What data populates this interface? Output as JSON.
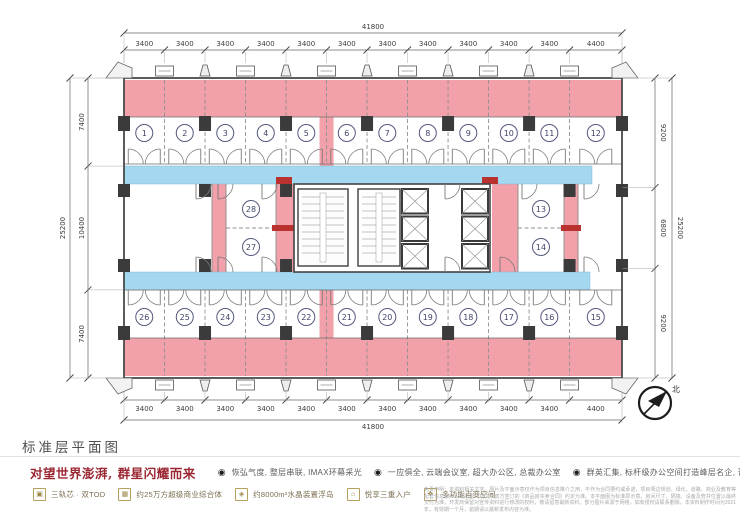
{
  "plan": {
    "title": "标准层平面图",
    "compass_label": "北",
    "colors": {
      "pink": "#f2a0a9",
      "red": "#b9322f",
      "blue": "#a4d7f0",
      "column": "#3b3b3b",
      "wall": "#6e6e6e",
      "dim": "#3c3c3c",
      "circle": "#55597d",
      "number": "#3f4468"
    },
    "dims": {
      "top_total_mm": 41800,
      "top_segments_mm": [
        3400,
        3400,
        3400,
        3400,
        3400,
        3400,
        3400,
        3400,
        3400,
        3400,
        3400,
        4400
      ],
      "bottom_total_mm": 41800,
      "bottom_segments_mm": [
        3400,
        3400,
        3400,
        3400,
        3400,
        3400,
        3400,
        3400,
        3400,
        3400,
        3400,
        4400
      ],
      "left_total_mm": 25200,
      "left_segments_mm": [
        7400,
        10400,
        7400
      ],
      "right_total_mm": 25200,
      "right_segments_mm": [
        9200,
        6800,
        9200
      ]
    },
    "rooms": {
      "top": [
        "1",
        "2",
        "3",
        "4",
        "5",
        "6",
        "7",
        "8",
        "9",
        "10",
        "11",
        "12"
      ],
      "bottom": [
        "26",
        "25",
        "24",
        "23",
        "22",
        "21",
        "20",
        "19",
        "18",
        "17",
        "16",
        "15"
      ],
      "mid_left": [
        "28",
        "27"
      ],
      "mid_right": [
        "13",
        "14"
      ]
    }
  },
  "footer": {
    "tagline": "对望世界澎湃, 群星闪耀而来",
    "bullet_glyph": "◉",
    "features": [
      "恢弘气度, 整层串联, IMAX环幕采光",
      "一应俱全, 云端会议室, 超大办公区, 总裁办公室",
      "群英汇集, 标杆级办公空间打造峰层名企, 菁英慕名而来"
    ],
    "amenities": [
      {
        "icon": "train-icon",
        "glyph": "▣",
        "label": "三轨芯 · 双TOD"
      },
      {
        "icon": "mall-icon",
        "glyph": "▦",
        "label": "约25万方超级商业综合体"
      },
      {
        "icon": "island-icon",
        "glyph": "◈",
        "label": "约8000m²水晶装置浮岛"
      },
      {
        "icon": "entry-icon",
        "glyph": "⌂",
        "label": "悦享三重入户"
      },
      {
        "icon": "space-icon",
        "glyph": "❖",
        "label": "多功能百变空间"
      }
    ],
    "disclaimer": "免责声明：本资料相关文字、图片及平面示意仅作为项目信息推介之用，不作为合同要约或承诺，项目周边规划、绿化、道路、商业及教育等配套信息最终以政府部门批文及双方签订的《商品房买卖合同》约定为准。本平面图为标准层示意，房间尺寸、隔墙、设备及管井位置以最终交付为准，开发商保留对宣传资料进行修改的权利，敬请留意最新资料。部分图片来源于网络，如有侵权请联系删除。本资料制作时间为2021年，有效期一个月，逾期请以最新发布内容为准。"
  }
}
